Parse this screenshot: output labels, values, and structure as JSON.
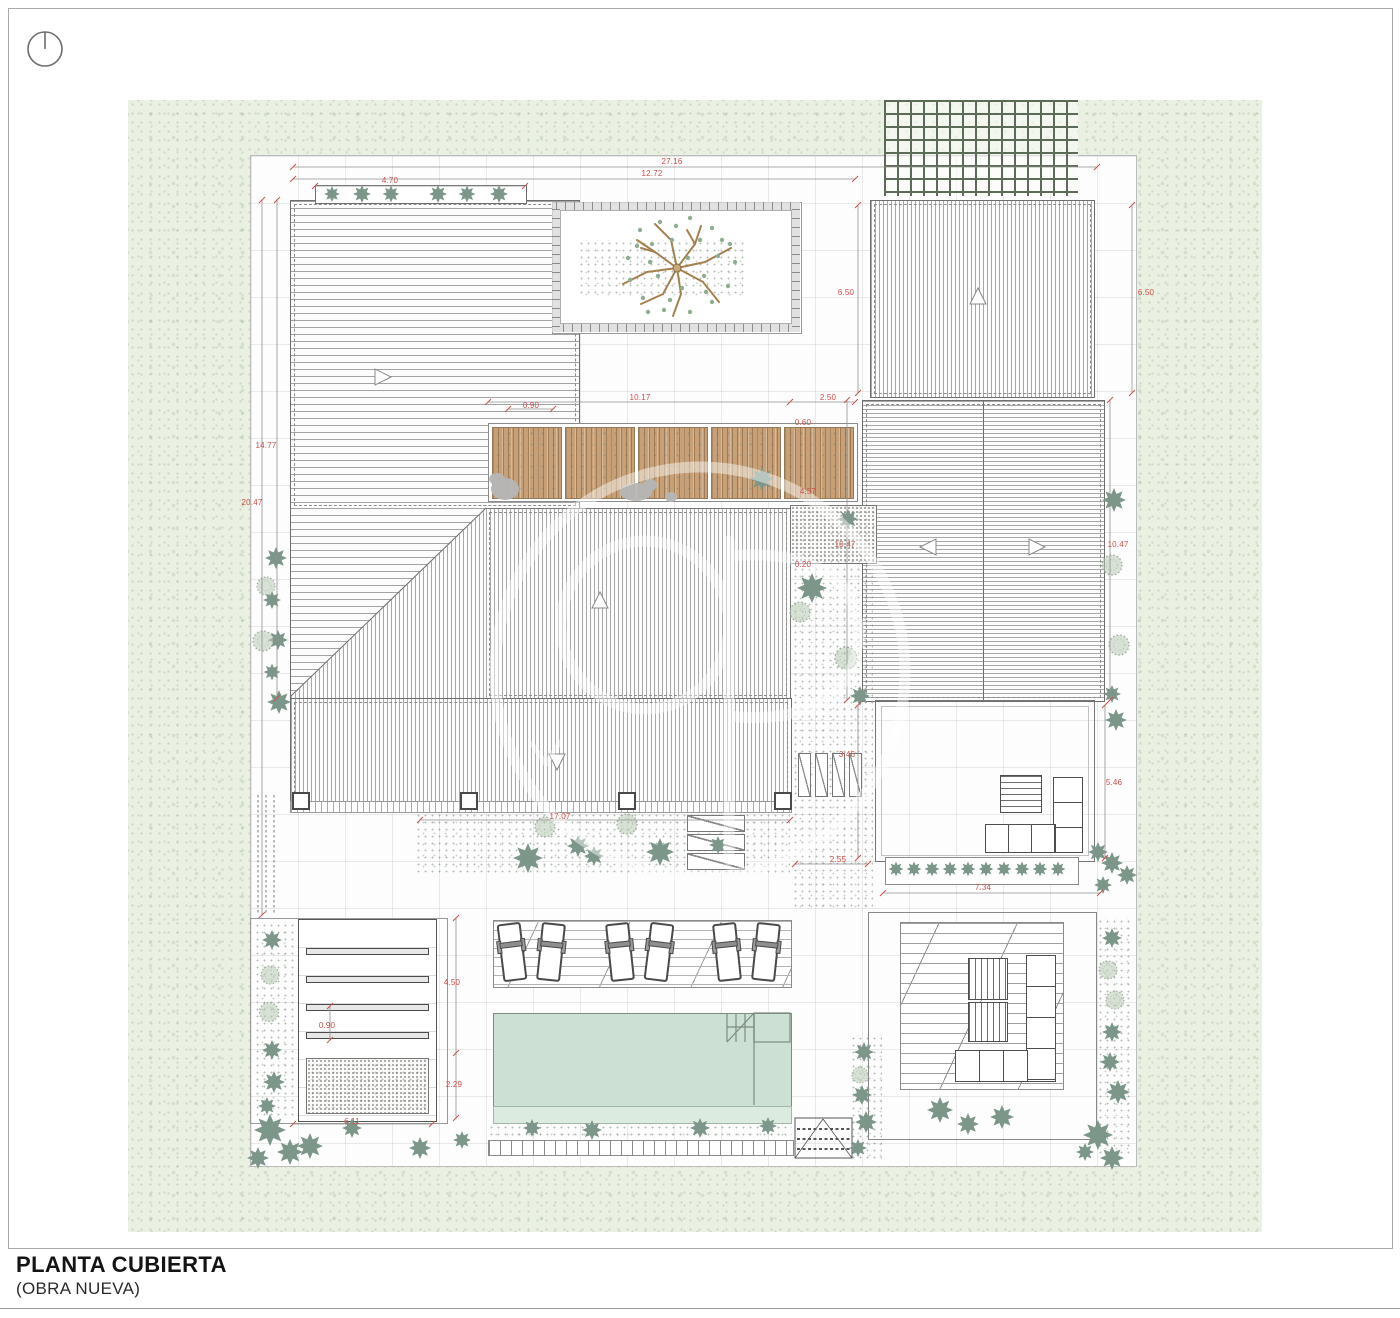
{
  "title_block": {
    "title": "PLANTA CUBIERTA",
    "subtitle": "(OBRA NUEVA)"
  },
  "plan": {
    "type": "architectural roof plan",
    "north_indicator": "circle with vertical needle",
    "watermark": "aP architect logo circle"
  },
  "dimensions": [
    "27.16",
    "12.72",
    "4.70",
    "6.50",
    "6.50",
    "14.77",
    "20.47",
    "0.90",
    "10.17",
    "2.50",
    "0.60",
    "4.57",
    "10.47",
    "10.47",
    "0.20",
    "3.46",
    "5.46",
    "17.07",
    "2.55",
    "7.34",
    "4.50",
    "0.90",
    "2.29",
    "6.11"
  ],
  "colors": {
    "dimension_red": "#cf4e49",
    "background_green": "#eaf0e2",
    "pool_water": "#cde0d4",
    "wood_deck": "#c7a078",
    "vegetation": "#7c978a",
    "trellis_green": "#5c6b57"
  }
}
